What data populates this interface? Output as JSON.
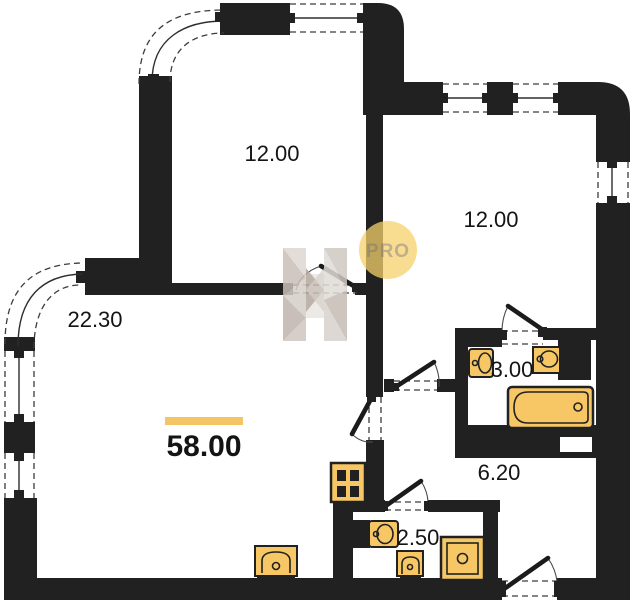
{
  "plan": {
    "unit": {
      "total_area_label": "58.00"
    },
    "rooms": [
      {
        "name": "bedroom-upper-left",
        "area_label": "12.00"
      },
      {
        "name": "bedroom-right",
        "area_label": "12.00"
      },
      {
        "name": "living-room",
        "area_label": "22.30"
      },
      {
        "name": "bathroom",
        "area_label": "3.00"
      },
      {
        "name": "hallway",
        "area_label": "6.20"
      },
      {
        "name": "wc",
        "area_label": "2.50"
      }
    ],
    "watermark": {
      "badge_text": "PRO"
    },
    "colors": {
      "background": "#ffffff",
      "wall": "#212121",
      "fixture_fill": "#f7c766",
      "accent_bar": "#f3c565",
      "watermark_circle": "#f6d26b",
      "watermark_text": "#b3a177",
      "watermark_gray": "#cfc7c0"
    },
    "fixture_icons": [
      "bathtub-icon",
      "washbasin-icon",
      "toilet-icon",
      "shower-tray-icon",
      "kitchen-sink-icon",
      "ventilation-shaft-icon"
    ]
  }
}
